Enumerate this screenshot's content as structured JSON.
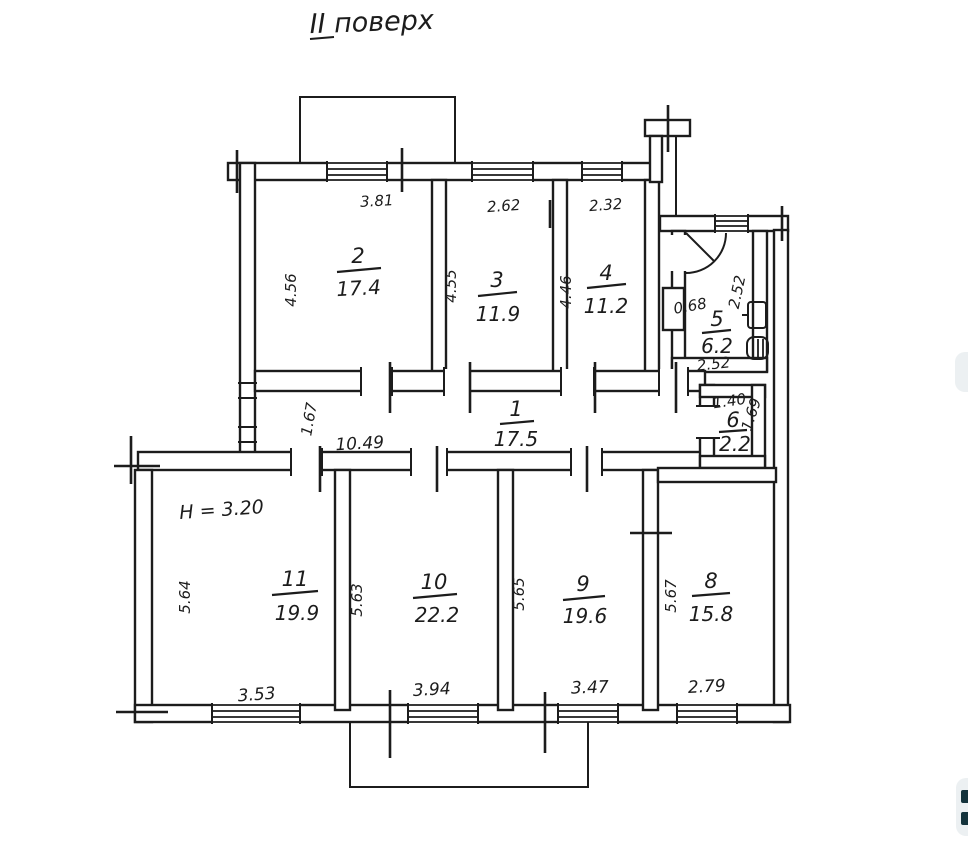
{
  "title": "II поверх",
  "plan": {
    "height_note": "H = 3.20",
    "rooms": {
      "r1": {
        "number": "1",
        "area": "17.5",
        "length": "10.49",
        "width": "1.67"
      },
      "r2": {
        "number": "2",
        "area": "17.4",
        "width": "3.81",
        "depth": "4.56"
      },
      "r3": {
        "number": "3",
        "area": "11.9",
        "width": "2.62",
        "depth": "4.55"
      },
      "r4": {
        "number": "4",
        "area": "11.2",
        "width": "2.32",
        "depth": "4.46"
      },
      "r5": {
        "number": "5",
        "area": "6.2",
        "niche_width": "0.68",
        "width": "2.52",
        "depth": "2.52"
      },
      "r6": {
        "number": "6",
        "area": "2.2",
        "width": "1.40",
        "depth": "1.69"
      },
      "r8": {
        "number": "8",
        "area": "15.8",
        "width": "2.79",
        "depth": "5.67"
      },
      "r9": {
        "number": "9",
        "area": "19.6",
        "width": "3.47",
        "depth": "5.65"
      },
      "r10": {
        "number": "10",
        "area": "22.2",
        "width": "3.94",
        "depth": "5.63"
      },
      "r11": {
        "number": "11",
        "area": "19.9",
        "width": "3.53",
        "depth": "5.64"
      }
    }
  },
  "colors": {
    "ink": "#1c1c1c",
    "paper": "#ffffff",
    "edge_widget_bg": "#ecf0f2",
    "edge_widget_glyph": "#14333c"
  }
}
